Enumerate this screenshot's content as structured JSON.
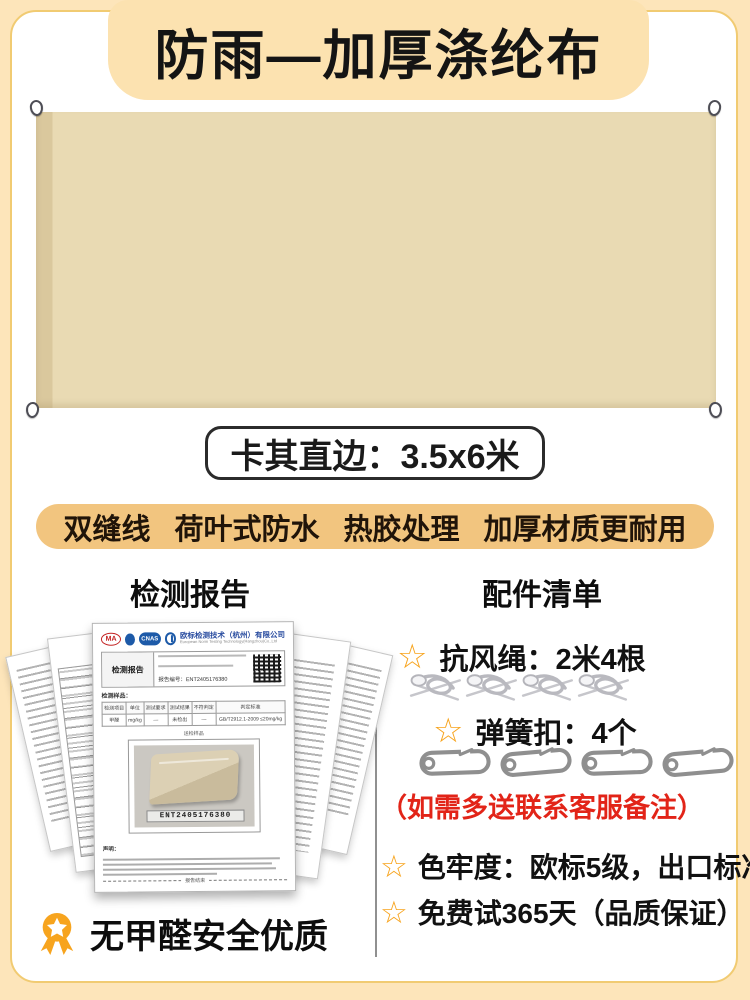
{
  "colors": {
    "page_bg": "#FDE5BA",
    "banner_bg": "#FCE2B0",
    "card_border": "#F1CB72",
    "tarp": "#E9DAB3",
    "tarp_edge": "#DAC89D",
    "pill_bg": "#F2C57F",
    "accent_orange": "#F7A41E",
    "note_red": "#E22418"
  },
  "banner": {
    "title": "防雨—加厚涤纶布"
  },
  "tarp": {
    "size_label": "卡其直边：3.5x6米"
  },
  "features": {
    "items": [
      "双缝线",
      "荷叶式防水",
      "热胶处理",
      "加厚材质更耐用"
    ]
  },
  "sections": {
    "report_title": "检测报告",
    "accessories_title": "配件清单"
  },
  "report": {
    "cma_label": "MA",
    "cnas_label": "CNAS",
    "company_cn": "欧标检测技术（杭州）有限公司",
    "company_en": "European Norm Testing Technology(Hangzhou)Co.,Ltd",
    "doc_title": "检测报告",
    "report_no": "报告编号：ENT2405176380",
    "sample_label": "检测样品：",
    "table_headers": [
      "检测项目",
      "单位",
      "测试要求",
      "测试结果",
      "不符判定",
      "判定标准"
    ],
    "table_row": [
      "甲醛",
      "mg/kg",
      "—",
      "未检出",
      "—",
      "GB/T2912.1-2009 ≤20mg/kg"
    ],
    "photo_caption": "送检样品",
    "sample_code": "ENT2405176380",
    "statement_label": "声明：",
    "end_label": "报告结束"
  },
  "accessories": {
    "star_glyph": "☆",
    "items": [
      {
        "label": "抗风绳：2米4根",
        "icon": "rope",
        "count": 4
      },
      {
        "label": "弹簧扣：4个",
        "icon": "carabiner",
        "count": 4
      }
    ],
    "note": "（如需多送联系客服备注）",
    "bullets": [
      "色牢度：欧标5级，出口标准",
      "免费试365天（品质保证）"
    ]
  },
  "footer": {
    "badge_text": "无甲醛安全优质"
  }
}
